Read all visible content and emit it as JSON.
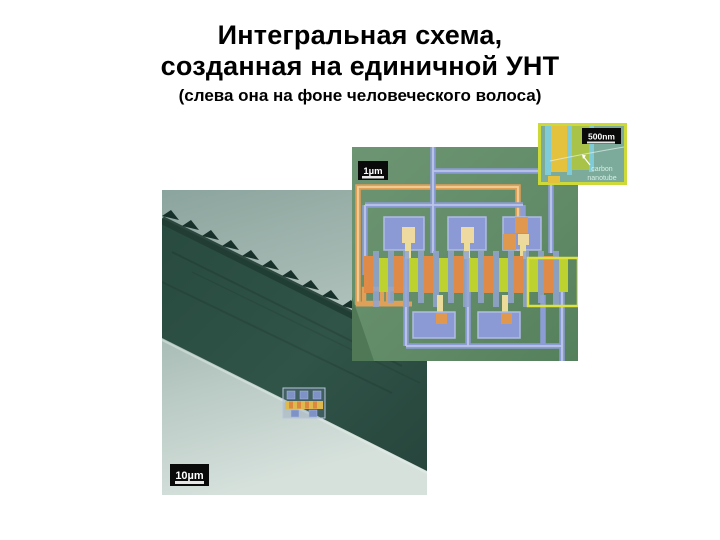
{
  "slide": {
    "title_line1": "Интегральная схема,",
    "title_line2": "созданная на единичной УНТ",
    "subtitle": "(слева она на фоне человеческого волоса)"
  },
  "hair_micrograph": {
    "scale_label": "10µm"
  },
  "circuit_micrograph": {
    "scale_label": "1µm"
  },
  "inset": {
    "scale_label": "500nm",
    "caption_line1": "carbon",
    "caption_line2": "nanotube"
  },
  "colors": {
    "circuit_background": "#618a66",
    "wire_blue": "#8c9cd4",
    "electrode_orange": "#e08a48",
    "electrode_lime": "#bdd12f",
    "highlight_yellow": "#dde33c",
    "inset_background": "#7cab9c",
    "inset_border": "#cdd839",
    "hair_dark": "#2d4f44",
    "sem_background": "#aebfb9",
    "scale_label_background": "#0a0a0a"
  }
}
